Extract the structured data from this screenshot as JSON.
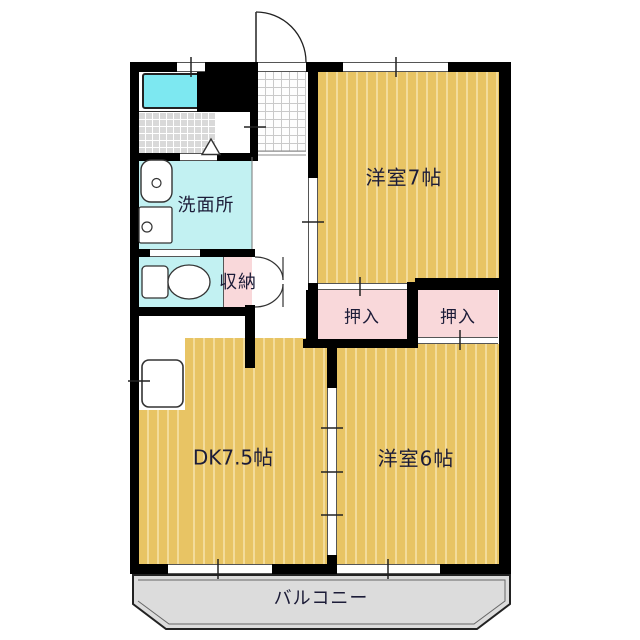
{
  "colors": {
    "floor": "#e8c464",
    "floor_stripe": "#f3dc9b",
    "closet": "#f9d8da",
    "wet": "#c2f1f2",
    "tub": "#7de8f1",
    "tile": "#d9d9d9",
    "balcony": "#dcdcdc",
    "wall": "#000000",
    "text": "#1c1c38",
    "line": "#333333"
  },
  "rooms": {
    "western7": {
      "label": "洋室7帖"
    },
    "western6": {
      "label": "洋室6帖"
    },
    "dk": {
      "label": "DK7.5帖"
    },
    "washroom": {
      "label": "洗面所"
    },
    "closet_left": {
      "label": "押入"
    },
    "closet_right": {
      "label": "押入"
    },
    "storage": {
      "label": "収納"
    },
    "balcony": {
      "label": "バルコニー"
    }
  }
}
